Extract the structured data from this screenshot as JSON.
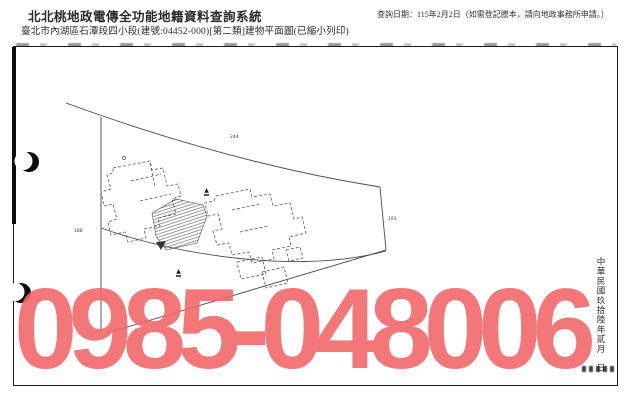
{
  "header": {
    "system_title": "北北桃地政電傳全功能地籍資料查詢系統",
    "location_line": "臺北市內湖區石潭段四小段(建號:04452-000)[第二類]建物平面圖(已縮小列印)",
    "query_note": "查詢日期：115年2月2日（如需登記謄本，請向地政事務所申請。）"
  },
  "plan": {
    "lot_labels": [
      {
        "text": "244"
      },
      {
        "text": "188"
      },
      {
        "text": "191"
      }
    ],
    "survey_markers": [
      {
        "symbol": "▲"
      },
      {
        "symbol": "▲"
      }
    ],
    "date_stamp": {
      "era_text": "中華民國玖拾陸年貳月",
      "day_suffix": "日"
    }
  },
  "watermark": {
    "phone_number": "0985-048006",
    "color": "#f2696b"
  },
  "colors": {
    "frame_border": "#1c1c1c",
    "line_gray": "#4a4a4a",
    "background": "#ffffff"
  }
}
